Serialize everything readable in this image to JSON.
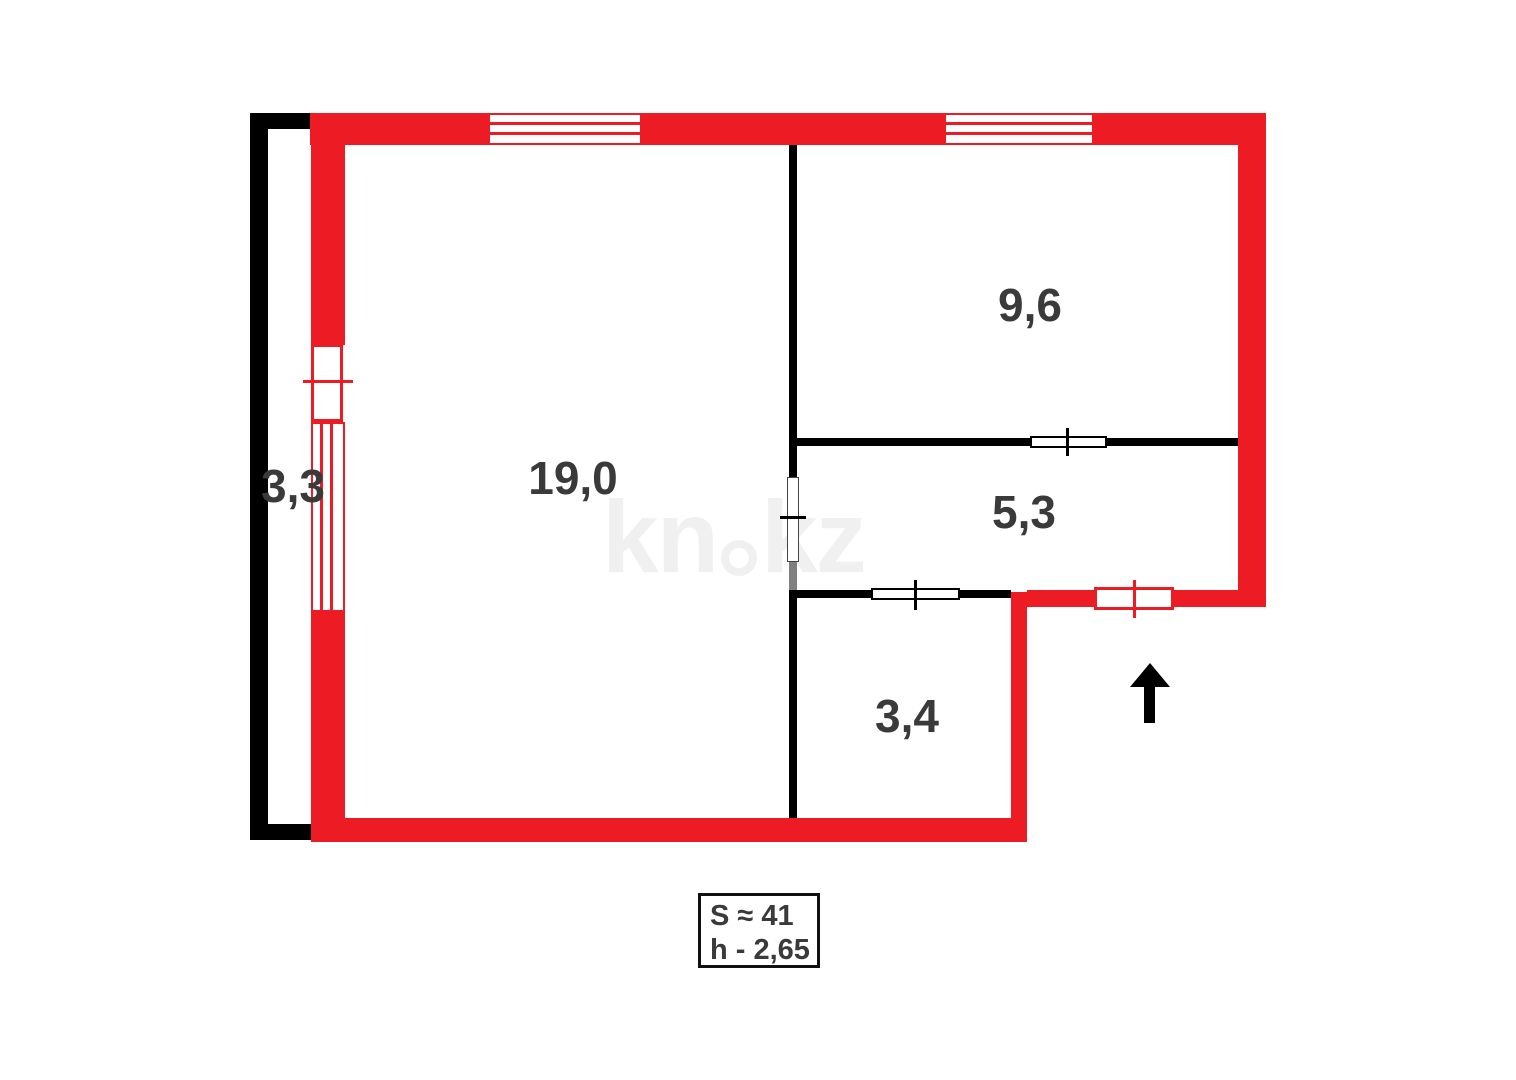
{
  "plan": {
    "type": "apartment-floor-plan",
    "rooms": [
      {
        "name": "balcony",
        "area": "3,3"
      },
      {
        "name": "living-room",
        "area": "19,0"
      },
      {
        "name": "bedroom",
        "area": "9,6"
      },
      {
        "name": "hallway",
        "area": "5,3"
      },
      {
        "name": "entry",
        "area": "3,4"
      }
    ],
    "summary": {
      "total_area": "S ≈ 41",
      "ceiling_height": "h - 2,65"
    },
    "watermark": {
      "full": "kn.kz",
      "left": "kn",
      "right": "kz"
    },
    "colors": {
      "outer_wall_red": "#ed1c24",
      "inner_wall_black": "#000000",
      "opening_gray": "#808080",
      "label_text": "#3a3a3a",
      "watermark": "#f0f0f0"
    }
  }
}
